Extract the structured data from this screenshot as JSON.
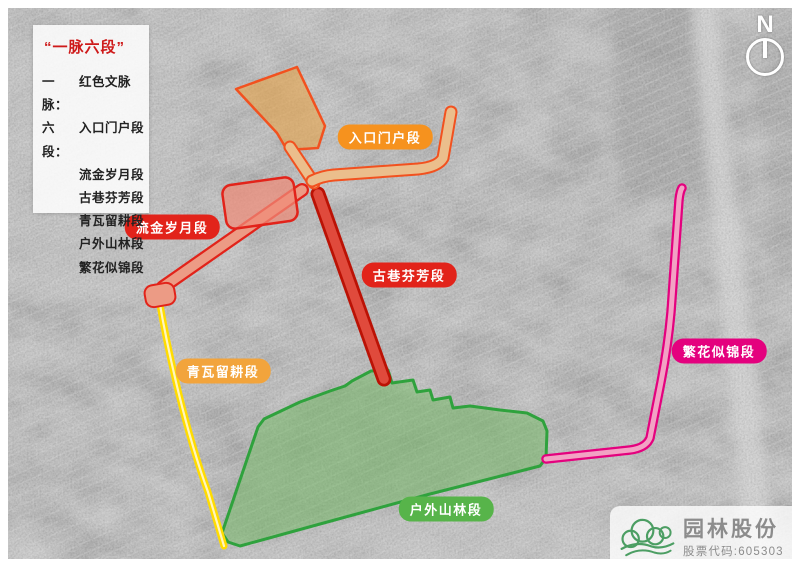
{
  "legend": {
    "title": "“一脉六段”",
    "vein_label": "一脉：",
    "vein_value": "红色文脉",
    "segments_label": "六段："
  },
  "routes": {
    "entrance": {
      "label": "入口门户段",
      "label_bg": "#F6921E",
      "fill": "#EBBE8C",
      "area_fill": "rgba(231,164,76,0.62)",
      "outline": "#F2511F"
    },
    "liujin": {
      "label": "流金岁月段",
      "label_bg": "#E2231A",
      "fill": "#EC9B85",
      "area_fill": "rgba(240,140,120,0.72)",
      "outline": "#E2231A"
    },
    "guxiang": {
      "label": "古巷芬芳段",
      "label_bg": "#E2231A",
      "fill": "#E04A3C",
      "outline": "#BB1205"
    },
    "qingwa": {
      "label": "青瓦留耕段",
      "label_bg": "#F2A43C",
      "fill": "#FFDC00",
      "core": "#FFF5BE"
    },
    "huwai": {
      "label": "户外山林段",
      "label_bg": "#57B44A",
      "fill": "rgba(118,192,102,0.5)",
      "outline": "#2FA23D"
    },
    "fanhua": {
      "label": "繁花似锦段",
      "label_bg": "#E4017E",
      "fill": "#F2A2C4",
      "outline": "#E4017E"
    }
  },
  "compass": {
    "north_label": "N"
  },
  "logo": {
    "company_name": "园林股份",
    "stock_code": "股票代码:605303",
    "brand_green": "#4C9E63",
    "text_gray": "#8C8C8C"
  },
  "colors": {
    "legend_title": "#CE1A1A",
    "legend_text": "#222222"
  }
}
